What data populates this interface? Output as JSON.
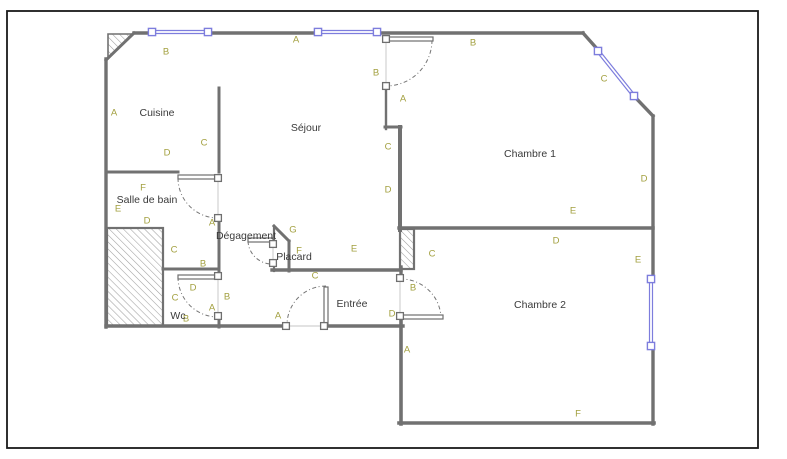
{
  "meta": {
    "type": "floor-plan"
  },
  "colors": {
    "background": "#ffffff",
    "frame": "#1a1a1a",
    "wall": "#717171",
    "wall_light": "#7d7d7d",
    "window": "#7d7ddd",
    "opening": "#d9d9d9",
    "arc": "#767676",
    "leaf_stroke": "#6f6f6f",
    "hatch_line": "#a0a0a0",
    "hatch_border": "#717171",
    "room_text": "#3a3a3a",
    "dim_text": "#a3a040"
  },
  "frame": {
    "x": 7,
    "y": 11,
    "w": 751,
    "h": 437
  },
  "rooms": [
    {
      "name": "Cuisine",
      "x": 157,
      "y": 112
    },
    {
      "name": "Séjour",
      "x": 306,
      "y": 127
    },
    {
      "name": "Chambre 1",
      "x": 530,
      "y": 153
    },
    {
      "name": "Salle de bain",
      "x": 147,
      "y": 199
    },
    {
      "name": "Dégagement",
      "x": 246,
      "y": 235
    },
    {
      "name": "Placard",
      "x": 294,
      "y": 256
    },
    {
      "name": "Entrée",
      "x": 352,
      "y": 303
    },
    {
      "name": "Wc",
      "x": 178,
      "y": 315
    },
    {
      "name": "Chambre 2",
      "x": 540,
      "y": 304
    }
  ],
  "dim_labels": [
    {
      "t": "B",
      "x": 166,
      "y": 51
    },
    {
      "t": "A",
      "x": 296,
      "y": 39
    },
    {
      "t": "A",
      "x": 114,
      "y": 112
    },
    {
      "t": "C",
      "x": 204,
      "y": 142
    },
    {
      "t": "D",
      "x": 167,
      "y": 152
    },
    {
      "t": "B",
      "x": 376,
      "y": 72
    },
    {
      "t": "A",
      "x": 403,
      "y": 98
    },
    {
      "t": "B",
      "x": 473,
      "y": 42
    },
    {
      "t": "C",
      "x": 604,
      "y": 78
    },
    {
      "t": "D",
      "x": 644,
      "y": 178
    },
    {
      "t": "C",
      "x": 388,
      "y": 146
    },
    {
      "t": "D",
      "x": 388,
      "y": 189
    },
    {
      "t": "E",
      "x": 573,
      "y": 210
    },
    {
      "t": "F",
      "x": 143,
      "y": 187
    },
    {
      "t": "E",
      "x": 118,
      "y": 208
    },
    {
      "t": "D",
      "x": 147,
      "y": 220
    },
    {
      "t": "A",
      "x": 212,
      "y": 222
    },
    {
      "t": "C",
      "x": 174,
      "y": 249
    },
    {
      "t": "B",
      "x": 203,
      "y": 263
    },
    {
      "t": "G",
      "x": 293,
      "y": 229
    },
    {
      "t": "F",
      "x": 299,
      "y": 250
    },
    {
      "t": "E",
      "x": 354,
      "y": 248
    },
    {
      "t": "C",
      "x": 432,
      "y": 253
    },
    {
      "t": "D",
      "x": 556,
      "y": 240
    },
    {
      "t": "E",
      "x": 638,
      "y": 259
    },
    {
      "t": "C",
      "x": 315,
      "y": 275
    },
    {
      "t": "D",
      "x": 193,
      "y": 287
    },
    {
      "t": "C",
      "x": 175,
      "y": 297
    },
    {
      "t": "B",
      "x": 186,
      "y": 318
    },
    {
      "t": "A",
      "x": 212,
      "y": 307
    },
    {
      "t": "B",
      "x": 227,
      "y": 296
    },
    {
      "t": "A",
      "x": 278,
      "y": 315
    },
    {
      "t": "D",
      "x": 392,
      "y": 313
    },
    {
      "t": "B",
      "x": 413,
      "y": 287
    },
    {
      "t": "A",
      "x": 407,
      "y": 349
    },
    {
      "t": "F",
      "x": 578,
      "y": 413
    }
  ],
  "walls": [
    [
      134,
      33,
      152,
      33,
      3.4
    ],
    [
      208,
      33,
      318,
      33,
      3.4
    ],
    [
      377,
      33,
      583,
      33,
      3.4
    ],
    [
      134,
      33,
      106,
      60,
      3.0
    ],
    [
      106,
      59,
      106,
      327,
      3.4
    ],
    [
      106,
      326,
      288,
      326,
      3.4
    ],
    [
      322,
      326,
      403,
      326,
      3.4
    ],
    [
      401,
      316,
      401,
      424,
      3.6
    ],
    [
      399,
      423,
      654,
      423,
      3.6
    ],
    [
      653,
      424,
      653,
      346,
      3.4
    ],
    [
      653,
      279,
      653,
      116,
      3.4
    ],
    [
      583,
      33,
      599,
      51,
      3.4
    ],
    [
      632,
      94,
      653,
      116,
      3.4
    ],
    [
      219,
      88,
      219,
      172,
      3.0
    ],
    [
      106,
      172,
      178,
      172,
      3.0
    ],
    [
      219,
      218,
      219,
      276,
      3.0
    ],
    [
      163,
      269,
      219,
      269,
      3.0
    ],
    [
      219,
      316,
      219,
      327,
      3.0
    ],
    [
      386,
      88,
      386,
      129,
      2.4
    ],
    [
      385,
      127,
      401,
      127,
      3.0
    ],
    [
      400,
      127,
      400,
      230,
      4.0
    ],
    [
      399,
      228,
      653,
      228,
      3.4
    ],
    [
      272,
      270,
      401,
      270,
      3.4
    ],
    [
      274,
      226,
      289,
      241,
      3.0
    ],
    [
      274,
      226,
      274,
      244,
      2.2
    ],
    [
      289,
      241,
      289,
      271,
      3.0
    ],
    [
      274,
      262,
      274,
      271,
      2.2
    ],
    [
      401,
      267,
      401,
      279,
      3.4
    ]
  ],
  "windows": [
    [
      152,
      32,
      208,
      32
    ],
    [
      318,
      32,
      377,
      32
    ],
    [
      598,
      51,
      634,
      96
    ],
    [
      651,
      279,
      651,
      346
    ]
  ],
  "door_squares": [
    [
      386,
      39
    ],
    [
      386,
      86
    ],
    [
      218,
      178
    ],
    [
      218,
      218
    ],
    [
      218,
      276
    ],
    [
      218,
      316
    ],
    [
      273,
      244
    ],
    [
      273,
      263
    ],
    [
      286,
      326
    ],
    [
      324,
      326
    ],
    [
      400,
      278
    ],
    [
      400,
      316
    ]
  ],
  "openings": [
    [
      386,
      41,
      386,
      84
    ],
    [
      218,
      180,
      218,
      216
    ],
    [
      218,
      278,
      218,
      314
    ],
    [
      273,
      246,
      273,
      261
    ],
    [
      288,
      326,
      322,
      326
    ],
    [
      400,
      280,
      400,
      314
    ]
  ],
  "leaves": [
    [
      388,
      37,
      45,
      4
    ],
    [
      178,
      175,
      40,
      4
    ],
    [
      178,
      275,
      40,
      4
    ],
    [
      248,
      238,
      25,
      4
    ],
    [
      324,
      287,
      4,
      39
    ],
    [
      402,
      315,
      41,
      4
    ]
  ],
  "arcs": [
    "M432,40 A46,46 0 0 1 386,86",
    "M178,178 A40,40 0 0 0 218,218",
    "M178,277 A40,40 0 0 0 218,317",
    "M248,241 A24,24 0 0 0 272,264",
    "M326,286 A39,39 0 0 0 287,325",
    "M400,279 A40,40 0 0 1 441,318"
  ],
  "hatch_triangle": "133,34 108,59 108,34",
  "hatch_rects": [
    [
      107,
      228,
      56,
      98
    ],
    [
      400,
      229,
      14,
      40
    ]
  ]
}
